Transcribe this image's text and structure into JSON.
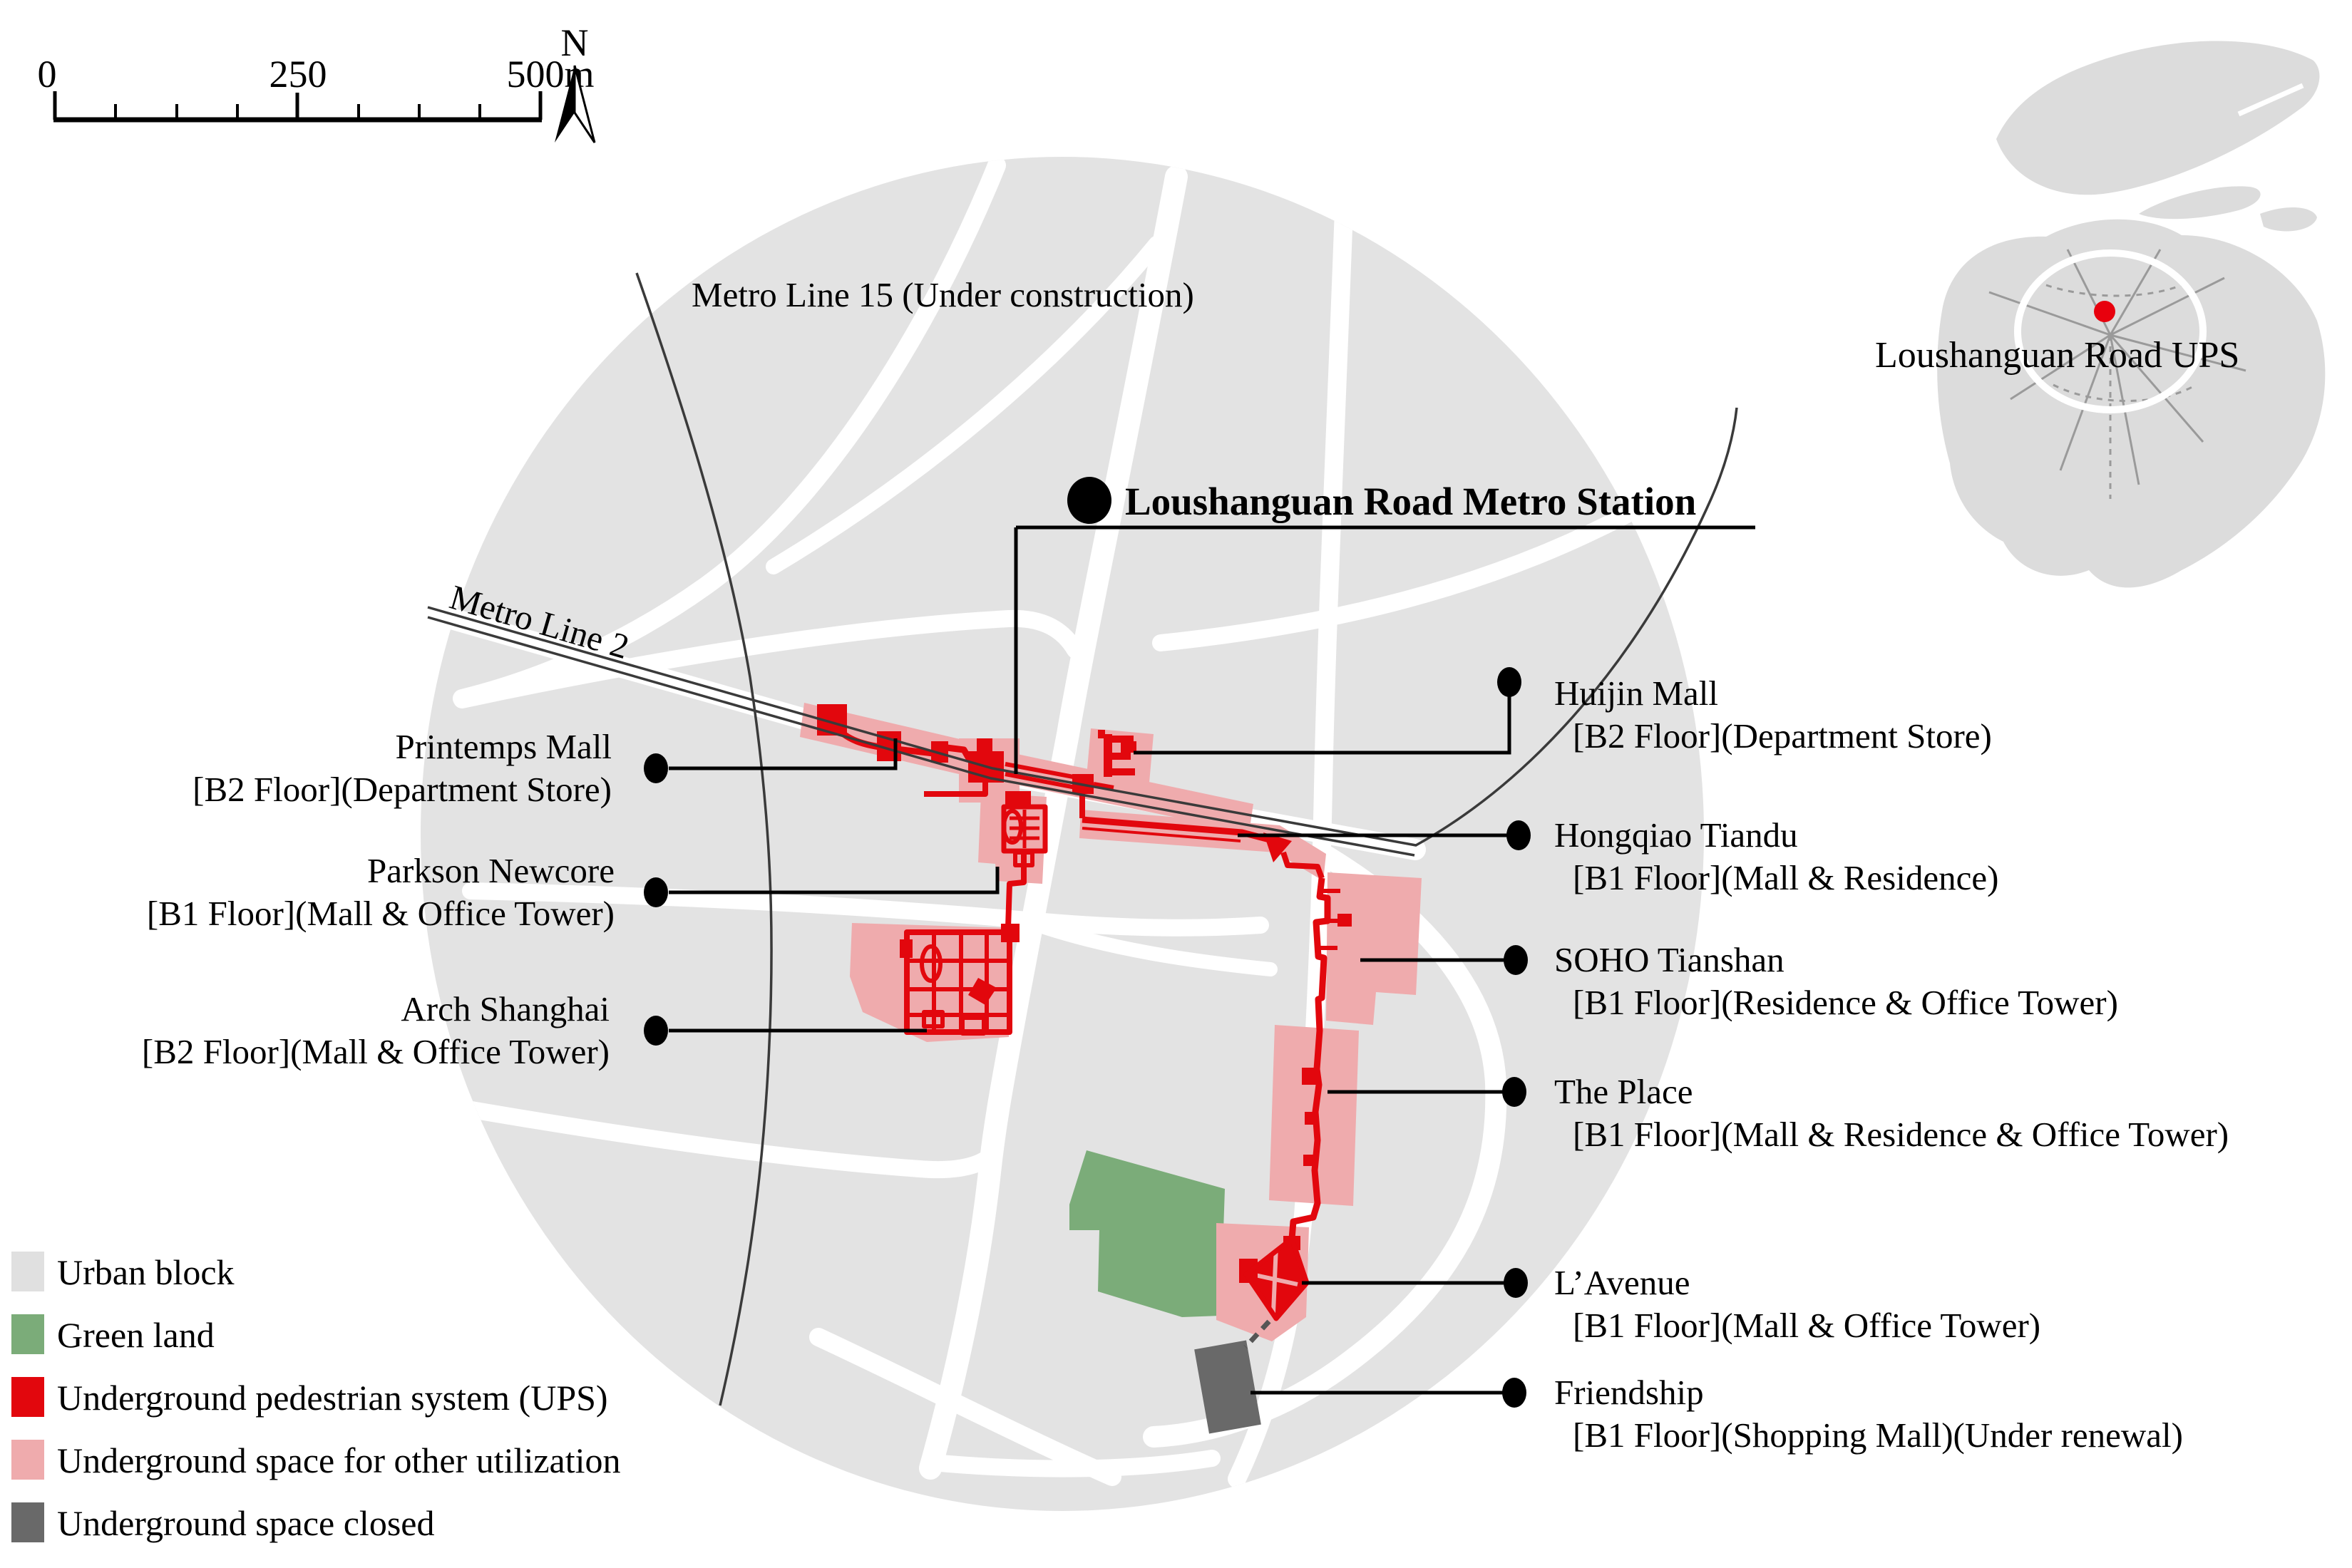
{
  "scalebar": {
    "t0": "0",
    "t250": "250",
    "t500": "500m"
  },
  "north": {
    "label": "N"
  },
  "metro": {
    "line15": "Metro Line 15 (Under construction)",
    "line2": "Metro Line 2"
  },
  "station": {
    "symbol": "M",
    "name": "Loushanguan Road Metro Station"
  },
  "callouts": {
    "left": [
      {
        "name": "Printemps Mall",
        "detail": "[B2 Floor](Department Store)"
      },
      {
        "name": "Parkson Newcore",
        "detail": "[B1 Floor](Mall & Office Tower)"
      },
      {
        "name": "Arch Shanghai",
        "detail": "[B2 Floor](Mall & Office Tower)"
      }
    ],
    "right": [
      {
        "name": "Huijin Mall",
        "detail": "[B2 Floor](Department Store)"
      },
      {
        "name": "Hongqiao Tiandu",
        "detail": "[B1 Floor](Mall & Residence)"
      },
      {
        "name": "SOHO Tianshan",
        "detail": "[B1 Floor](Residence & Office Tower)"
      },
      {
        "name": "The Place",
        "detail": "[B1 Floor](Mall & Residence & Office Tower)"
      },
      {
        "name": "L’Avenue",
        "detail": "[B1 Floor](Mall & Office Tower)"
      },
      {
        "name": "Friendship",
        "detail": "[B1 Floor](Shopping Mall)(Under renewal)"
      }
    ]
  },
  "legend": {
    "items": [
      {
        "label": "Urban block",
        "color": "#e0e0e0"
      },
      {
        "label": "Green land",
        "color": "#7bac79"
      },
      {
        "label": "Underground pedestrian system (UPS)",
        "color": "#e2070d"
      },
      {
        "label": "Underground space for other utilization",
        "color": "#efabad"
      },
      {
        "label": "Underground space closed",
        "color": "#696969"
      }
    ]
  },
  "inset": {
    "label": "Loushanguan Road UPS",
    "marker_color": "#e8000d"
  },
  "colors": {
    "urban_block": "#e3e3e3",
    "road": "#ffffff",
    "ups_red": "#e2070d",
    "other_utilization_pink": "#efabad",
    "closed_gray": "#696969",
    "green_land": "#7bac79",
    "metro_line": "#3a3a3a",
    "leader": "#000000"
  }
}
